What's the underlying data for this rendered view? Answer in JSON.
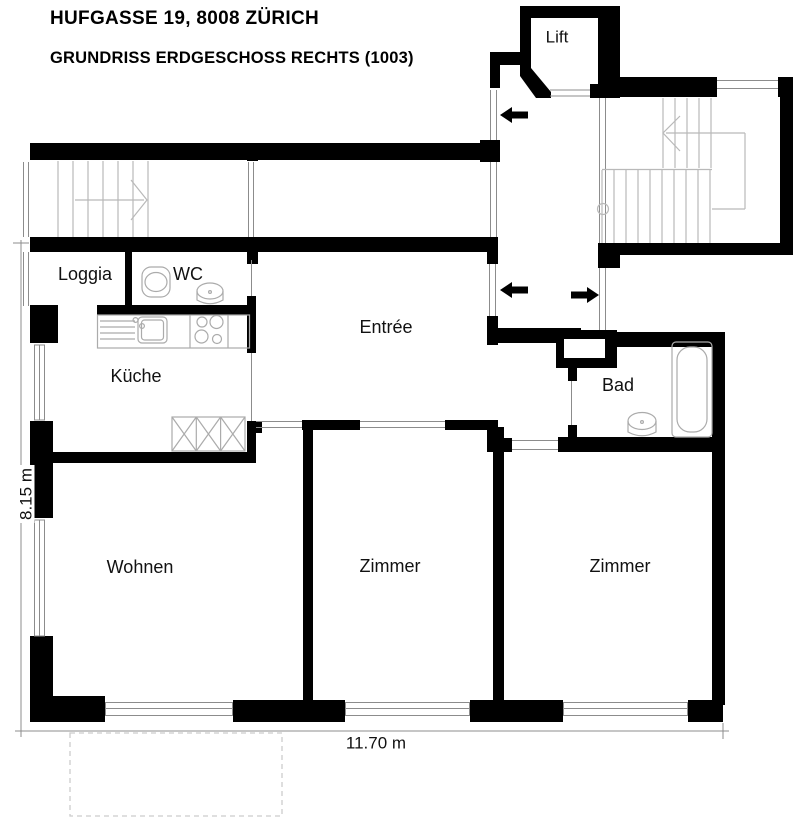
{
  "header": {
    "address": "HUFGASSE 19, 8008 ZÜRICH",
    "plan_title": "GRUNDRISS ERDGESCHOSS RECHTS (1003)"
  },
  "rooms": {
    "lift": "Lift",
    "loggia": "Loggia",
    "wc": "WC",
    "kueche": "Küche",
    "entree": "Entrée",
    "bad": "Bad",
    "wohnen": "Wohnen",
    "zimmer_left": "Zimmer",
    "zimmer_right": "Zimmer"
  },
  "dimensions": {
    "height": "8.15 m",
    "width": "11.70 m"
  },
  "colors": {
    "wall": "#000000",
    "window_line": "#8c8c8c",
    "stair_line": "#b9b9b9",
    "fixture_line": "#ababab",
    "dimension_line": "#8c8c8c"
  }
}
